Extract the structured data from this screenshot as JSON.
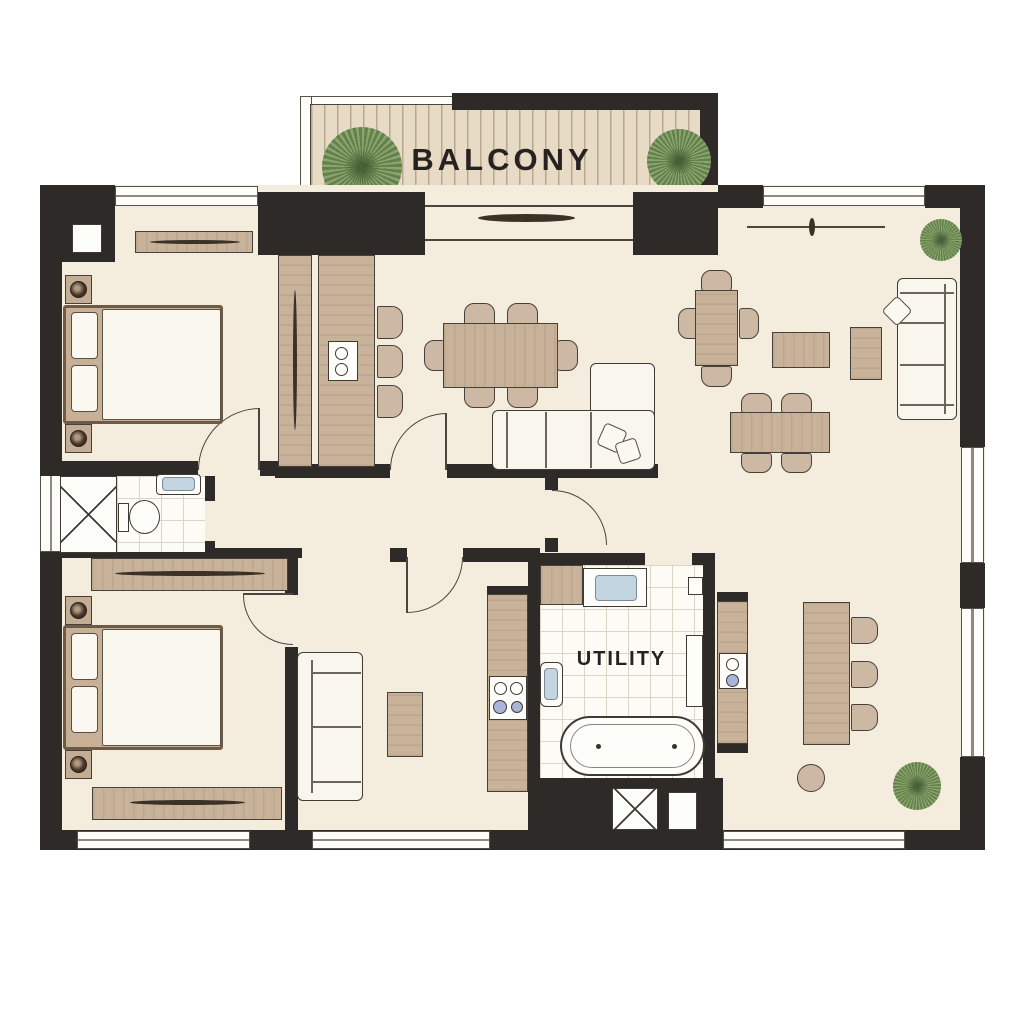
{
  "labels": {
    "balcony": "BALCONY",
    "utility": "UTILITY"
  },
  "palette": {
    "wall": "#2d2a27",
    "floor": "#f4ecdd",
    "wood": "#c8b29a",
    "deck": "#e8dbc5",
    "chair": "#cdb9a3",
    "white_furniture": "#faf7ee",
    "outline": "#45403a",
    "plant_light": "#8aa56d",
    "plant_dark": "#64804b",
    "tile": "#fcfbf6",
    "tile_line": "#dcd5c6",
    "sink": "#c3d5e1",
    "burner": "#a9b6d9",
    "lens": "#3b3127"
  }
}
